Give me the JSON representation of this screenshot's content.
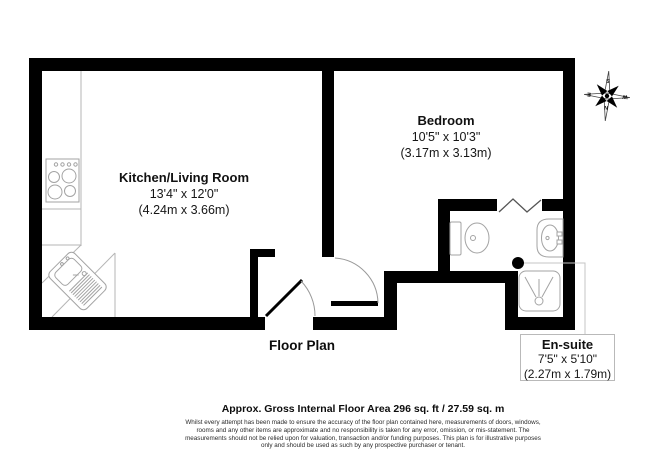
{
  "plan": {
    "title": "Floor Plan",
    "rooms": [
      {
        "name": "Kitchen/Living Room",
        "imperial": "13'4\" x 12'0\"",
        "metric": "(4.24m x 3.66m)"
      },
      {
        "name": "Bedroom",
        "imperial": "10'5\" x 10'3\"",
        "metric": "(3.17m x 3.13m)"
      },
      {
        "name": "En-suite",
        "imperial": "7'5\" x 5'10\"",
        "metric": "(2.27m x 1.79m)"
      }
    ],
    "fixtures": [
      "hob",
      "sink-drainer-unit",
      "toilet",
      "wash-basin",
      "shower-tray"
    ]
  },
  "compass": {
    "n": "N",
    "s": "S",
    "e": "E",
    "w": "W",
    "rotation_deg": 184
  },
  "footer": {
    "area_line": "Approx. Gross Internal Floor Area 296 sq. ft / 27.59 sq. m",
    "disclaimer_lines": [
      "Whilst every attempt has been made to ensure the accuracy of the floor plan contained here, measurements of doors, windows,",
      "rooms and any other items are approximate and no responsibility is taken for any error, omission, or mis-statement. The",
      "measurements should not be relied upon for valuation, transaction and/or funding purposes. This plan is for illustrative purposes",
      "only and should be used as such by any prospective purchaser or tenant."
    ]
  },
  "colors": {
    "wall": "#000000",
    "fixture_outline": "#a3a3a3",
    "door_arc": "#999999",
    "label_box_border": "#b9b9b9",
    "leader_line": "#c4c4c4",
    "text": "#111111"
  }
}
